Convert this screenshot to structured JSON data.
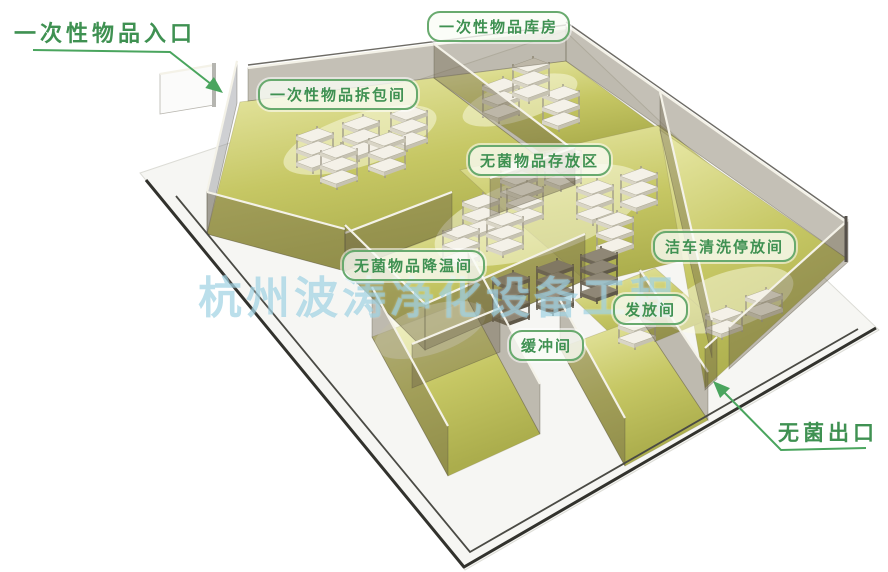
{
  "diagram_title": "洁净室平面布局图",
  "annotations": {
    "entrance": {
      "text": "一次性物品入口"
    },
    "exit": {
      "text": "无菌出口"
    }
  },
  "room_labels": [
    {
      "id": "warehouse",
      "text": "一次性物品库房"
    },
    {
      "id": "unpacking",
      "text": "一次性物品拆包间"
    },
    {
      "id": "storage",
      "text": "无菌物品存放区"
    },
    {
      "id": "cooling",
      "text": "无菌物品降温间"
    },
    {
      "id": "cartwash",
      "text": "洁车清洗停放间"
    },
    {
      "id": "dispatch",
      "text": "发放间"
    },
    {
      "id": "buffer",
      "text": "缓冲间"
    }
  ],
  "watermark": {
    "text": "杭州波涛净化设备工程"
  },
  "colors": {
    "accent_green": "#3f9152",
    "arrow_green": "#4aa55e",
    "label_border": "#68aa6e",
    "label_bg": "rgba(250,252,246,0.80)",
    "watermark_blue": "rgba(146,203,222,0.62)",
    "platform": "#f6f6f3",
    "trim_dark": "#32322d",
    "floor_light": "#e9e9a8",
    "floor_mid": "#c6c764",
    "floor_deep": "#abad4c",
    "wall_khaki": "rgba(108,98,72,0.40)",
    "wall_gray": "rgba(130,132,140,0.38)",
    "wall_top": "#f4f2e8",
    "rack_top": "#f4f1e8",
    "rack_front": "#d9d5c6",
    "rack_side": "#c6c2b1",
    "dark_rack_top": "#8f8776",
    "dark_rack_front": "#6f6758",
    "dark_rack_side": "#5f5849"
  }
}
